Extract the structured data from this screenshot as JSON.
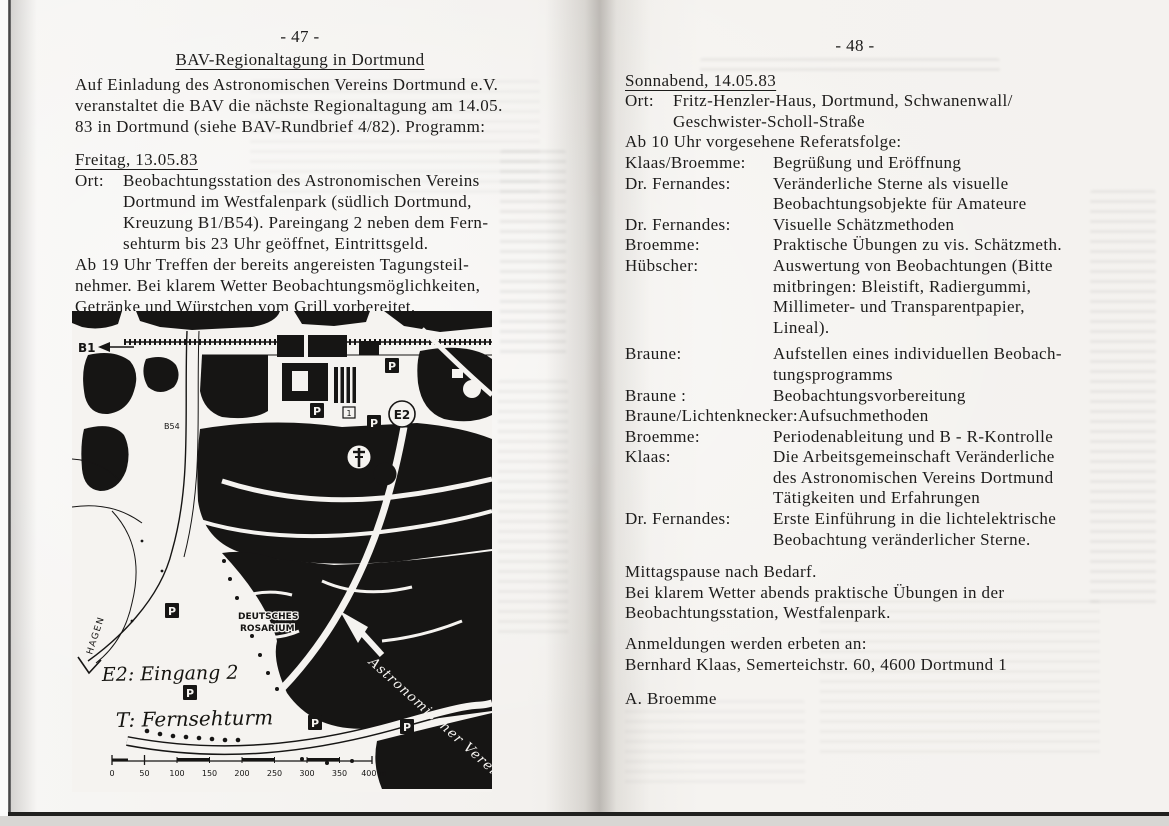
{
  "left_page": {
    "page_number": "- 47 -",
    "title": "BAV-Regionaltagung in Dortmund",
    "intro": "Auf Einladung des Astronomischen Vereins Dortmund e.V.\nveranstaltet die BAV die nächste Regionaltagung am 14.05.\n83 in Dortmund (siehe BAV-Rundbrief 4/82). Programm:",
    "freitag_heading": "Freitag, 13.05.83",
    "ort_label": "Ort:",
    "ort_text": "Beobachtungsstation des Astronomischen Vereins\nDortmund im Westfalenpark (südlich Dortmund,\nKreuzung B1/B54). Pareingang 2 neben dem Fern-\nsehturm bis 23 Uhr geöffnet, Eintrittsgeld.",
    "ab19_text": "Ab 19 Uhr Treffen der bereits angereisten Tagungsteil-\nnehmer. Bei klarem Wetter Beobachtungsmöglichkeiten,\nGetränke und Würstchen vom Grill vorbereitet.",
    "map": {
      "b1_label": "B1",
      "b54_label": "B54",
      "hagen_label": "HAGEN",
      "entrance_label": "E2",
      "tower_label": "T",
      "marker_1": "1",
      "parking_label": "P",
      "rosarium_line1": "DEUTSCHES",
      "rosarium_line2": "ROSARIUM",
      "astro_label": "Astronomischer Verein",
      "legend_e2": "E2: Eingang 2",
      "legend_t": "T: Fernsehturm",
      "scale_ticks": [
        "0",
        "50",
        "100",
        "150",
        "200",
        "250",
        "300",
        "350",
        "400 m"
      ],
      "ink_color": "#161514",
      "paper_color": "#f5f3f0"
    }
  },
  "right_page": {
    "page_number": "- 48 -",
    "heading": "Sonnabend, 14.05.83",
    "ort_label": "Ort:",
    "ort_text": "Fritz-Henzler-Haus, Dortmund, Schwanenwall/\nGeschwister-Scholl-Straße",
    "referatsfolge_line": "Ab 10 Uhr vorgesehene Referatsfolge:",
    "schedule": [
      {
        "speaker": "Klaas/Broemme:",
        "topic": "Begrüßung und Eröffnung"
      },
      {
        "speaker": "Dr. Fernandes:",
        "topic": "Veränderliche Sterne als visuelle\nBeobachtungsobjekte für Amateure"
      },
      {
        "speaker": "Dr. Fernandes:",
        "topic": "Visuelle Schätzmethoden"
      },
      {
        "speaker": "Broemme:",
        "topic": "Praktische Übungen zu vis. Schätzmeth."
      },
      {
        "speaker": "Hübscher:",
        "topic": "Auswertung von Beobachtungen (Bitte\nmitbringen: Bleistift, Radiergummi,\nMillimeter- und Transparentpapier,\nLineal)."
      },
      {
        "speaker": "Braune:",
        "topic": "Aufstellen eines individuellen Beobach-\ntungsprogramms"
      },
      {
        "speaker": "Braune :",
        "topic": "Beobachtungsvorbereitung"
      },
      {
        "speaker": "Braune/Lichtenknecker:",
        "topic": "Aufsuchmethoden"
      },
      {
        "speaker": "Broemme:",
        "topic": "Periodenableitung und B - R-Kontrolle"
      },
      {
        "speaker": "Klaas:",
        "topic": "Die Arbeitsgemeinschaft Veränderliche\ndes Astronomischen Vereins Dortmund\nTätigkeiten und Erfahrungen"
      },
      {
        "speaker": "Dr. Fernandes:",
        "topic": "Erste Einführung in die lichtelektrische\nBeobachtung veränderlicher Sterne."
      }
    ],
    "closing": "Mittagspause nach Bedarf.\nBei klarem Wetter abends praktische Übungen in der\nBeobachtungsstation, Westfalenpark.",
    "anmeldung": "Anmeldungen werden erbeten an:\nBernhard Klaas, Semerteichstr. 60, 4600 Dortmund 1",
    "signature": "A. Broemme"
  }
}
